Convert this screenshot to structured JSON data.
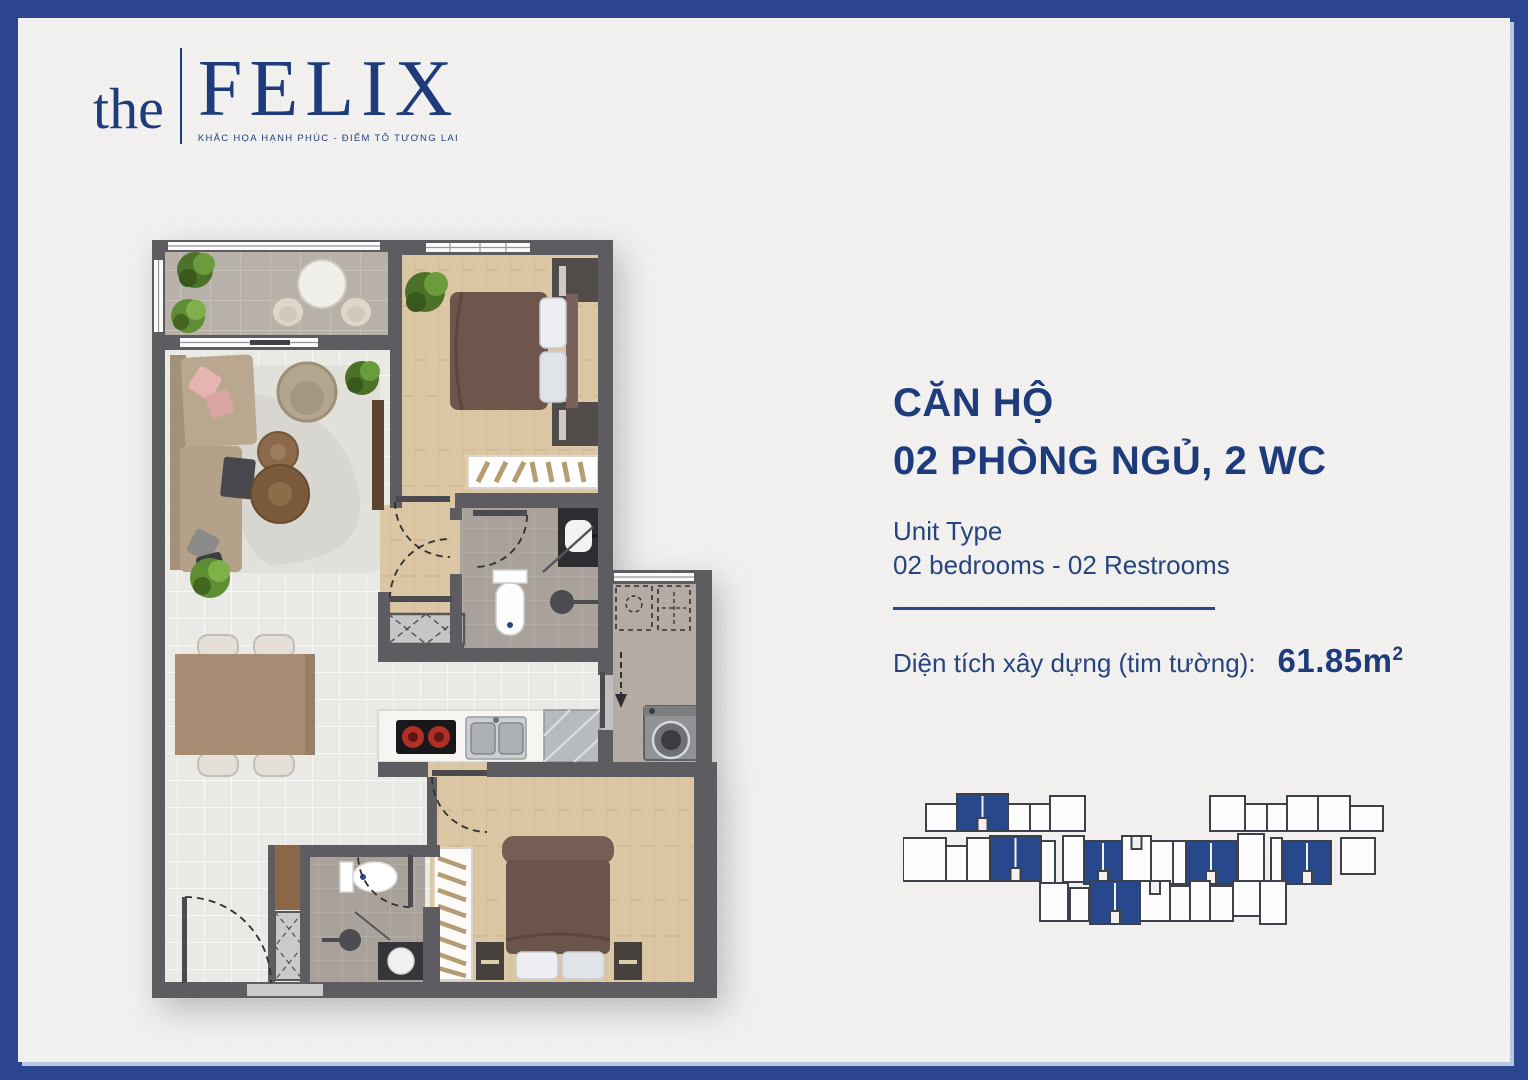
{
  "page": {
    "background": "#f2f1ef",
    "frame_color": "#2b4590"
  },
  "logo": {
    "prefix": "the",
    "name": "FELIX",
    "tagline": "KHẮC HỌA HẠNH PHÚC - ĐIỂM TÔ TƯƠNG LAI",
    "color": "#1e3c7c"
  },
  "unit_info": {
    "title_line1": "CĂN HỘ",
    "title_line2": "02 PHÒNG NGỦ, 2 WC",
    "unit_type_label": "Unit Type",
    "unit_type_value": "02 bedrooms - 02 Restrooms",
    "area_label": "Diện tích xây dựng (tim tường):",
    "area_value": "61.85m",
    "area_superscript": "2"
  },
  "colors": {
    "brand_navy": "#1e3c7c",
    "frame_blue": "#2b4590",
    "keyplan_highlight": "#27488c",
    "keyplan_outline": "#3c414b"
  },
  "keyplan": {
    "highlight": "#27488c",
    "outline": "#3c414b",
    "unit_fill": "#fdfdfd",
    "blocks": [
      [
        23,
        16,
        31,
        27,
        0,
        0
      ],
      [
        54,
        6,
        51,
        37,
        1,
        1
      ],
      [
        105,
        16,
        22,
        27,
        0,
        0
      ],
      [
        127,
        16,
        20,
        27,
        0,
        0
      ],
      [
        147,
        8,
        35,
        35,
        0,
        0
      ],
      [
        307,
        8,
        35,
        35,
        0,
        0
      ],
      [
        342,
        16,
        22,
        27,
        0,
        0
      ],
      [
        364,
        16,
        20,
        27,
        0,
        0
      ],
      [
        384,
        8,
        31,
        35,
        0,
        0
      ],
      [
        415,
        8,
        32,
        35,
        0,
        0
      ],
      [
        447,
        18,
        33,
        25,
        0,
        0
      ],
      [
        0,
        50,
        43,
        43,
        0,
        0
      ],
      [
        43,
        58,
        21,
        35,
        0,
        0
      ],
      [
        64,
        50,
        23,
        43,
        0,
        0
      ],
      [
        87,
        48,
        51,
        45,
        1,
        1
      ],
      [
        138,
        53,
        14,
        45,
        0,
        0
      ],
      [
        160,
        48,
        21,
        46,
        0,
        0
      ],
      [
        181,
        53,
        38,
        43,
        1,
        1
      ],
      [
        219,
        48,
        29,
        46,
        0,
        2
      ],
      [
        248,
        53,
        22,
        43,
        0,
        0
      ],
      [
        270,
        53,
        13,
        43,
        0,
        0
      ],
      [
        283,
        53,
        50,
        43,
        1,
        1
      ],
      [
        335,
        46,
        26,
        50,
        0,
        0
      ],
      [
        368,
        50,
        11,
        46,
        0,
        0
      ],
      [
        380,
        53,
        48,
        43,
        1,
        1
      ],
      [
        438,
        50,
        34,
        36,
        0,
        0
      ],
      [
        137,
        95,
        28,
        38,
        0,
        0
      ],
      [
        167,
        100,
        19,
        33,
        0,
        0
      ],
      [
        187,
        93,
        50,
        43,
        1,
        1
      ],
      [
        237,
        93,
        30,
        40,
        0,
        2
      ],
      [
        267,
        98,
        20,
        35,
        0,
        0
      ],
      [
        287,
        93,
        20,
        40,
        0,
        0
      ],
      [
        307,
        98,
        23,
        35,
        0,
        0
      ],
      [
        330,
        93,
        27,
        35,
        0,
        0
      ],
      [
        357,
        93,
        26,
        43,
        0,
        0
      ]
    ]
  }
}
